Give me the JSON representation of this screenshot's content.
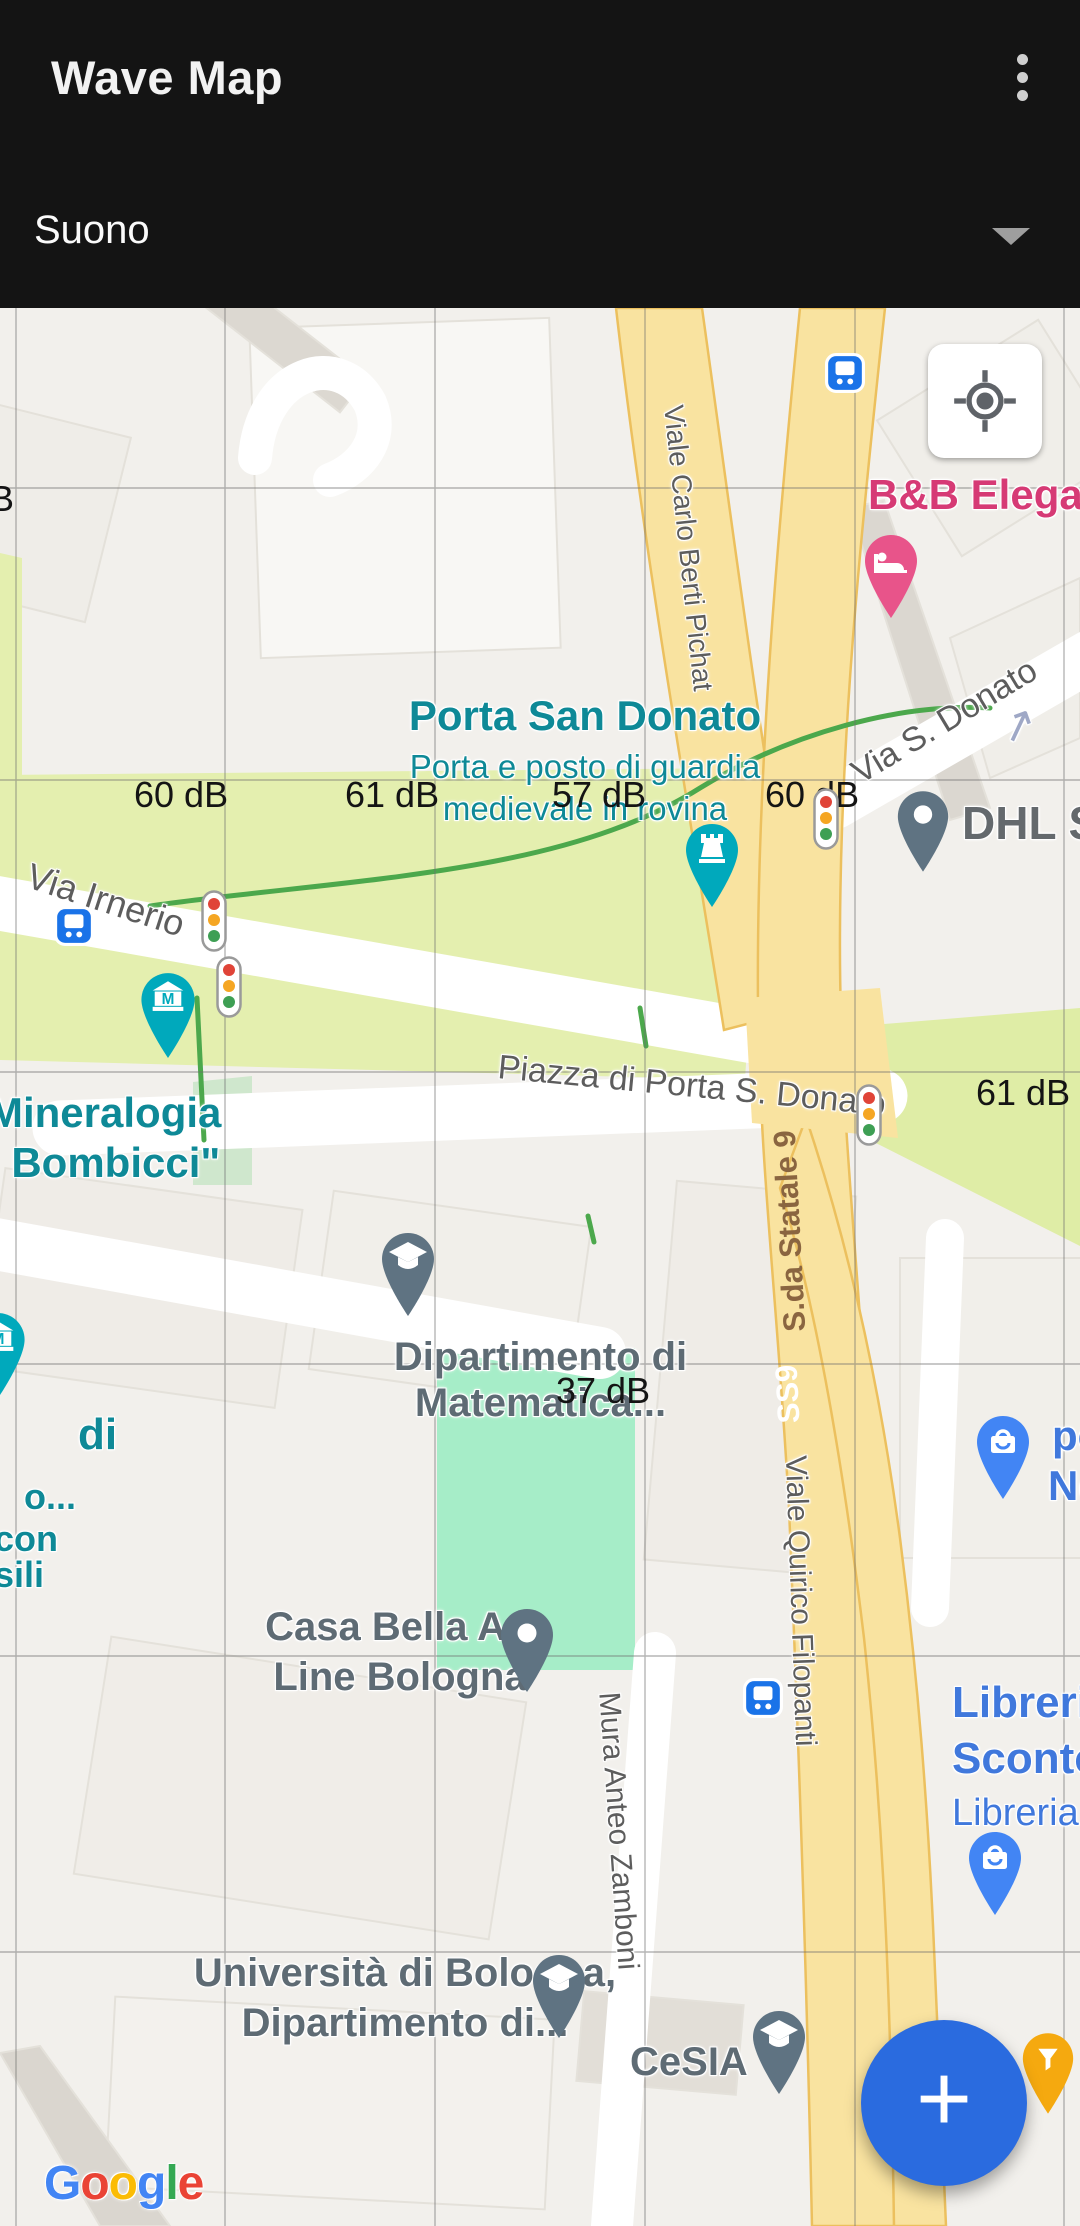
{
  "header": {
    "title": "Wave Map",
    "selector_value": "Suono"
  },
  "map": {
    "db_labels": [
      "60 dB",
      "61 dB",
      "57 dB",
      "60 dB",
      "61 dB",
      "37 dB",
      "B"
    ],
    "pois": {
      "porta_san_donato": {
        "title": "Porta San Donato",
        "line2": "Porta e posto di guardia",
        "line3": "medievale in rovina"
      },
      "bnb": "B&B Elegan",
      "dhl": "DHL S",
      "mineralogia": {
        "line1": "Mineralogia",
        "line2": "i Bombicci\""
      },
      "left_fragments": [
        "di",
        "o...",
        "con",
        "sili"
      ],
      "matematica": {
        "line1": "Dipartimento di",
        "line2": "Matematica..."
      },
      "po_ne": {
        "line1": "po",
        "line2": "Ne"
      },
      "casa_bella": {
        "line1": "Casa Bella Art",
        "line2": "Line Bologna"
      },
      "libreria": {
        "line1": "Libreria",
        "line2": "Sconto",
        "line3": "Libreria"
      },
      "universita": {
        "line1": "Università di Bologna,",
        "line2": "Dipartimento di..."
      },
      "cesia": "CeSIA"
    },
    "streets": {
      "via_irnerio": "Via Irnerio",
      "berti_pichat": "Viale Carlo Berti Pichat",
      "via_s_donato": "Via S. Donato",
      "donato_arrow": "↗",
      "piazza": "Piazza di Porta S. Donato",
      "statale": "S.da Statale 9",
      "ss9": "SS9",
      "filopanti": "Viale Quirico Filopanti",
      "zamboni": "Mura Anteo Zamboni"
    },
    "google_letters": [
      "G",
      "o",
      "o",
      "g",
      "l",
      "e"
    ],
    "fab_label": "+",
    "colors": {
      "fab_blue": "#2A6BDF",
      "teal_poi": "#0E8997",
      "pink_poi": "#D63A75",
      "blue_poi": "#4078DC",
      "gray_poi": "#5E6B74",
      "bus_blue": "#1A73E8",
      "road_yellow": "#F9E3A0",
      "park_green": "#E4EFAF",
      "highlight_mint": "#A6EDC8"
    }
  }
}
